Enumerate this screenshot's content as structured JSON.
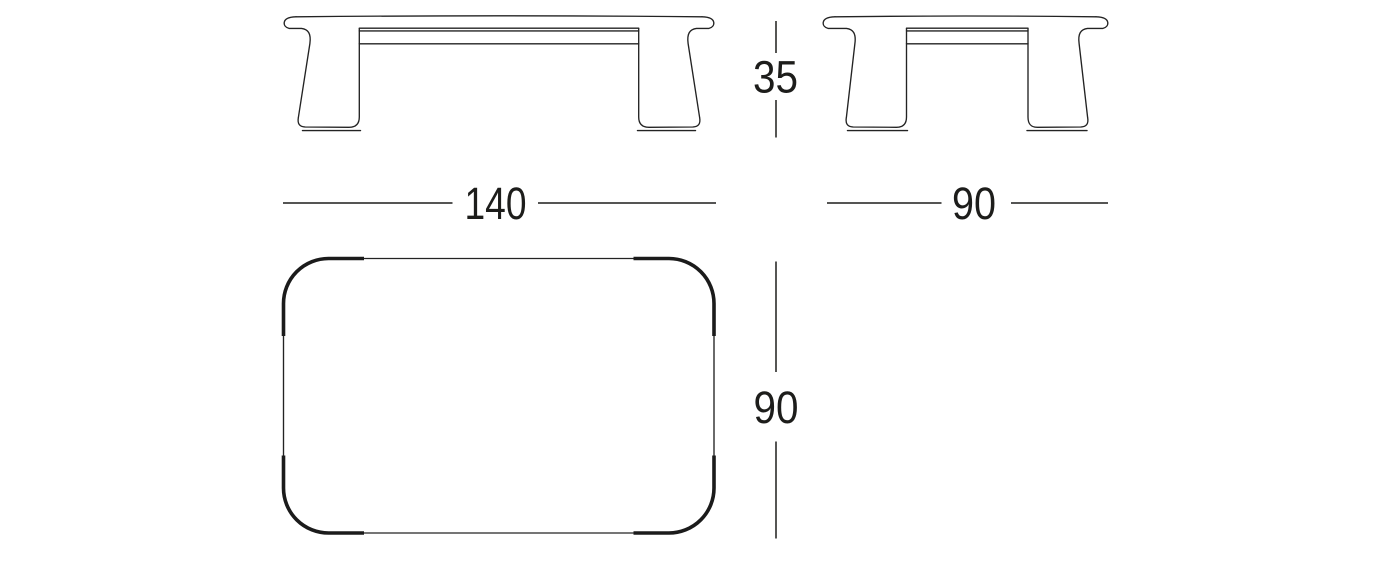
{
  "dimensions": {
    "height": "35",
    "width": "140",
    "depth_side": "90",
    "depth_plan": "90"
  },
  "colors": {
    "line": "#232323",
    "thick_corner": "#1b1b1b",
    "text": "#1d1d1b",
    "background": "#ffffff"
  },
  "views": {
    "front": "front-elevation",
    "side": "side-elevation",
    "plan": "top-plan"
  }
}
